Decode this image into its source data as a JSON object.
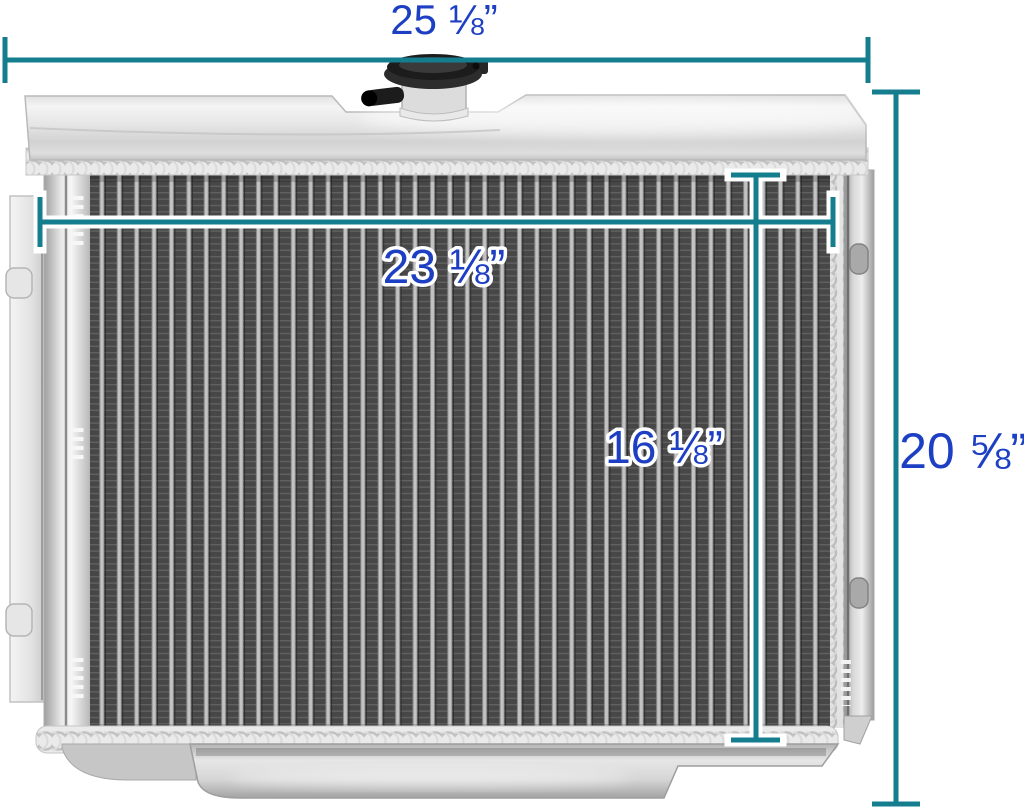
{
  "scene": {
    "description": "aluminum radiator product photo with dimension callouts",
    "background_color": "#ffffff"
  },
  "dimensions": {
    "line_color": "#157e8e",
    "label_color": "#1d3fc4",
    "overall_width": {
      "label": "25 ⅛”"
    },
    "overall_height": {
      "label": "20 ⅝”"
    },
    "core_width": {
      "label": "23 ⅛”"
    },
    "core_height": {
      "label": "16 ⅛”"
    }
  }
}
